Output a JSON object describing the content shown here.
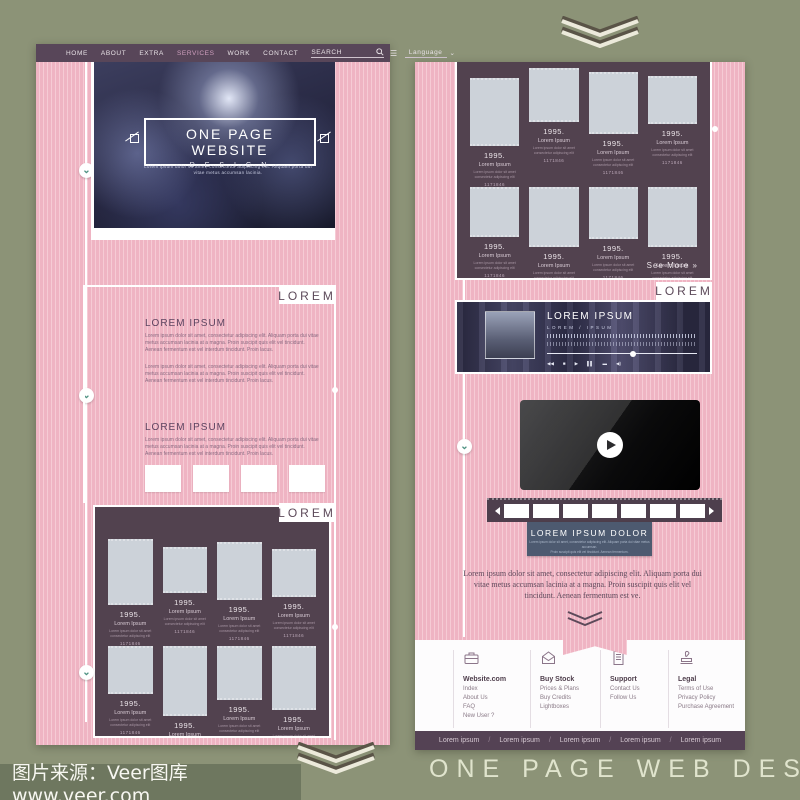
{
  "colors": {
    "background_olive": "#8c9377",
    "pink": "#efb4c3",
    "pink_stripe": "#f6cbd5",
    "plum_dark": "#52424f",
    "nav_bar": "#584659",
    "navy_button": "#4d5a70",
    "accent_green": "#4f9383",
    "cream": "#eceadb"
  },
  "watermark": {
    "text": "图片来源：Veer图库 www.veer.com"
  },
  "caption": {
    "text": "ONE PAGE WEB DESIGN"
  },
  "nav": {
    "items": [
      "HOME",
      "ABOUT",
      "EXTRA",
      "SERVICES",
      "WORK",
      "CONTACT"
    ],
    "search_label": "SEARCH",
    "language_label": "Language",
    "hamburger_glyph": "☰",
    "caret_glyph": "⌄"
  },
  "hero": {
    "title": "ONE PAGE WEBSITE",
    "subtitle": "—  D E S I G N  —",
    "tagline_line1": "Lorem ipsum dolor sit amet, consectetur adipiscing elit. Aliquam porta dui",
    "tagline_line2": "vitae metus accumsan lacinia."
  },
  "sections": {
    "lorem_tab": "LOREM",
    "block1": {
      "heading": "LOREM IPSUM",
      "para1": "Lorem ipsum dolor sit amet, consectetur adipiscing elit. Aliquam porta dui vitae metus accumsan lacinia at a magna. Proin suscipit quis elit vel tincidunt. Aenean fermentum est vel interdum tincidunt. Proin lacus.",
      "para2": "Lorem ipsum dolor sit amet, consectetur adipiscing elit. Aliquam porta dui vitae metus accumsan lacinia at a magna. Proin suscipit quis elit vel tincidunt. Aenean fermentum est vel interdum tincidunt. Proin lacus."
    },
    "block2": {
      "heading": "LOREM IPSUM",
      "para": "Lorem ipsum dolor sit amet, consectetur adipiscing elit. Aliquam porta dui vitae metus accumsan lacinia at a magna. Proin suscipit quis elit vel tincidunt. Aenean fermentum est vel interdum tincidunt. Proin lacus."
    }
  },
  "gallery_item": {
    "year": "1995.",
    "title": "Lorem Ipsum",
    "desc": "Lorem ipsum dolor sit amet consectetur adipiscing elit",
    "code": "1171846"
  },
  "chevron_glyph": "⌄",
  "right_page": {
    "see_more": "See More »",
    "lorem_tab": "LOREM",
    "player": {
      "title": "LOREM IPSUM",
      "subtitle": "LOREM / IPSUM",
      "controls": [
        "◀◀",
        "■",
        "▶",
        "▌▌",
        "▬",
        "◀)"
      ]
    },
    "cta": {
      "title": "LOREM IPSUM DOLOR",
      "line1": "Lorem ipsum dolor sit amet, consectetur adipiscing elit. Aliquam porta dui vitae metus accumsan.",
      "line2": "Proin suscipit quis elit vel tincidunt. Aenean fermentum."
    },
    "paragraph": "Lorem ipsum dolor sit amet, consectetur adipiscing elit. Aliquam porta dui vitae metus accumsan lacinia at a magna. Proin suscipit quis elit vel tincidunt. Aenean fermentum est ve.",
    "footer": {
      "columns": [
        {
          "icon": "briefcase-icon",
          "title": "Website.com",
          "links": [
            "Index",
            "About Us",
            "FAQ",
            "New User ?"
          ]
        },
        {
          "icon": "envelope-icon",
          "title": "Buy Stock",
          "links": [
            "Prices & Plans",
            "Buy Credits",
            "Lightboxes"
          ]
        },
        {
          "icon": "document-icon",
          "title": "Support",
          "links": [
            "Contact Us",
            "Follow Us"
          ]
        },
        {
          "icon": "stamp-icon",
          "title": "Legal",
          "links": [
            "Terms of Use",
            "Privacy Policy",
            "Purchase Agreement"
          ]
        }
      ]
    },
    "link_separator": "/",
    "bottom_links": [
      "Lorem ipsum",
      "Lorem ipsum",
      "Lorem ipsum",
      "Lorem ipsum",
      "Lorem ipsum"
    ]
  }
}
